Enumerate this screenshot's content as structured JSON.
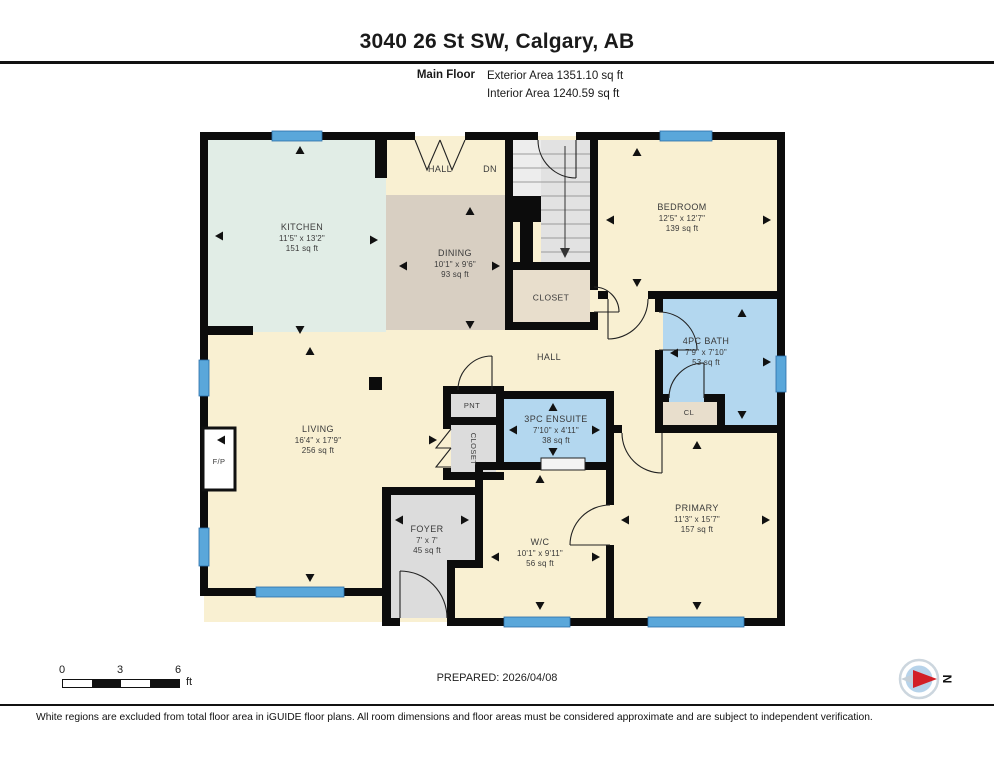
{
  "header": {
    "title": "3040 26 St SW, Calgary, AB",
    "floor_label": "Main Floor",
    "exterior_area": "Exterior Area 1351.10 sq ft",
    "interior_area": "Interior Area 1240.59 sq ft"
  },
  "rooms": {
    "kitchen": {
      "name": "KITCHEN",
      "dims": "11'5\" x 13'2\"",
      "area": "151 sq ft"
    },
    "dining": {
      "name": "DINING",
      "dims": "10'1\" x 9'6\"",
      "area": "93 sq ft"
    },
    "hall_top": {
      "name": "HALL"
    },
    "dn": {
      "name": "DN"
    },
    "bedroom": {
      "name": "BEDROOM",
      "dims": "12'5\" x 12'7\"",
      "area": "139 sq ft"
    },
    "closet_stairs": {
      "name": "CLOSET"
    },
    "bath": {
      "name": "4PC BATH",
      "dims": "7'9\" x 7'10\"",
      "area": "53 sq ft"
    },
    "cl": {
      "name": "CL"
    },
    "hall_mid": {
      "name": "HALL"
    },
    "pnt": {
      "name": "PNT"
    },
    "ensuite": {
      "name": "3PC ENSUITE",
      "dims": "7'10\" x 4'11\"",
      "area": "38 sq ft"
    },
    "closet_living": {
      "name": "CLOSET"
    },
    "living": {
      "name": "LIVING",
      "dims": "16'4\" x 17'9\"",
      "area": "256 sq ft"
    },
    "fp": {
      "name": "F/P"
    },
    "foyer": {
      "name": "FOYER",
      "dims": "7' x 7'",
      "area": "45 sq ft"
    },
    "wc": {
      "name": "W/C",
      "dims": "10'1\" x 9'11\"",
      "area": "56 sq ft"
    },
    "primary": {
      "name": "PRIMARY",
      "dims": "11'3\" x 15'7\"",
      "area": "157 sq ft"
    }
  },
  "scale": {
    "t0": "0",
    "t3": "3",
    "t6": "6",
    "unit": "ft"
  },
  "footer": {
    "prepared": "PREPARED: 2026/04/08",
    "compass_n": "N",
    "disclaimer": "White regions are excluded from total floor area in iGUIDE floor plans. All room dimensions and floor areas must be considered approximate and are subject to independent verification."
  },
  "colors": {
    "wall": "#0c0c0c",
    "cream": "#f9f0d2",
    "kitchen_green": "#e1ede6",
    "dining_tan": "#d8cfc2",
    "bath_blue": "#b3d7ef",
    "gray_room": "#dcdcdc",
    "closet_beige": "#e8decc",
    "window_blue": "#5aa7da",
    "compass_red": "#d21f26"
  }
}
